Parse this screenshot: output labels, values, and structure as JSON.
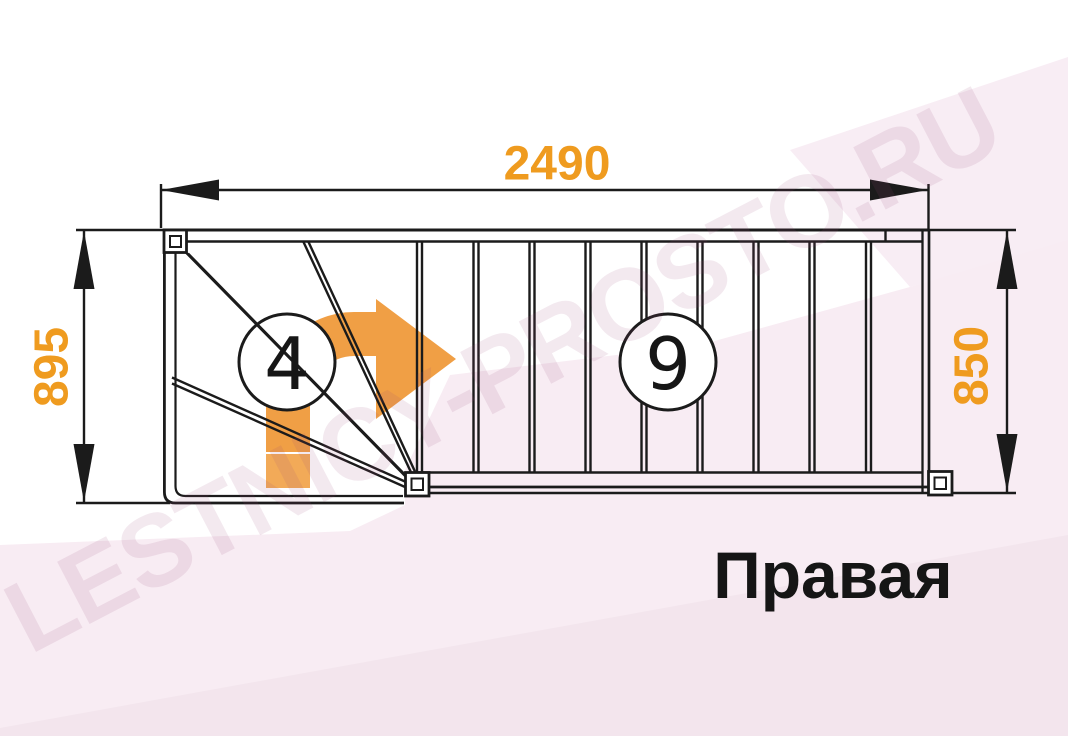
{
  "diagram": {
    "title": "Правая",
    "watermark": "LESTNICY-PROSTO.RU",
    "dimensions": {
      "top_width": "2490",
      "left_height": "895",
      "right_height": "850"
    },
    "winder_steps": "4",
    "straight_steps": "9",
    "colors": {
      "accent_orange": "#ef9b1f",
      "arrow_orange": "#f09f45",
      "arrow_tail_orange": "#f2aa58",
      "line_black": "#1b1b1b",
      "band_pink": "#f8ecf3",
      "band_pink_dark": "#efe2ea"
    }
  }
}
